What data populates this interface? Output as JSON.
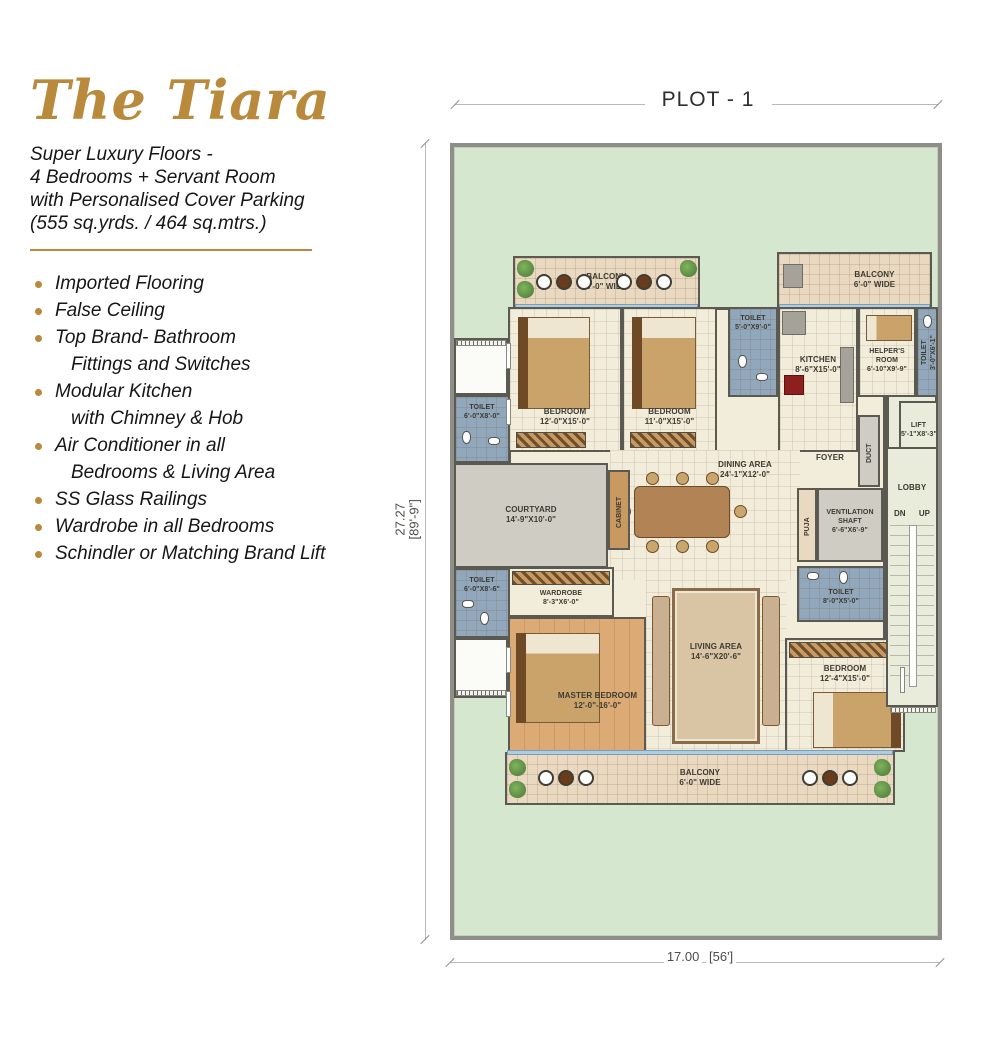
{
  "colors": {
    "accent": "#b9893c",
    "plot_green": "#d5e7ce",
    "toilet_blue": "#91a7bc"
  },
  "brand": {
    "title": "The Tiara",
    "subtitle_lines": [
      "Super Luxury Floors -",
      "4 Bedrooms + Servant Room",
      "with Personalised Cover Parking",
      "(555 sq.yrds. / 464 sq.mtrs.)"
    ]
  },
  "features": [
    {
      "text": "Imported Flooring"
    },
    {
      "text": "False Ceiling"
    },
    {
      "text": "Top Brand- Bathroom",
      "text2": "Fittings and Switches"
    },
    {
      "text": "Modular Kitchen",
      "text2": "with Chimney & Hob"
    },
    {
      "text": "Air Conditioner in all",
      "text2": "Bedrooms & Living Area"
    },
    {
      "text": "SS Glass Railings"
    },
    {
      "text": "Wardrobe in all Bedrooms"
    },
    {
      "text": "Schindler or Matching Brand Lift"
    }
  ],
  "plan": {
    "plot_label": "PLOT - 1",
    "dimensions": {
      "height_m": "27.27",
      "height_ft": "[89'-9\"]",
      "width_m": "17.00",
      "width_ft": "[56']"
    },
    "rooms": {
      "balcony_tl": {
        "name": "BALCONY",
        "dims": "6'-0\" WIDE"
      },
      "balcony_tr": {
        "name": "BALCONY",
        "dims": "6'-0\" WIDE"
      },
      "balcony_bottom": {
        "name": "BALCONY",
        "dims": "6'-0\" WIDE"
      },
      "bedroom1": {
        "name": "BEDROOM",
        "dims": "12'-0\"X15'-0\""
      },
      "bedroom2": {
        "name": "BEDROOM",
        "dims": "11'-0\"X15'-0\""
      },
      "toilet_top": {
        "name": "TOILET",
        "dims": "5'-0\"X9'-0\""
      },
      "kitchen": {
        "name": "KITCHEN",
        "dims": "8'-6\"X15'-0\""
      },
      "helpers_room": {
        "name": "HELPER'S ROOM",
        "dims": "6'-10\"X9'-9\""
      },
      "toilet_helpers": {
        "name": "TOILET",
        "dims": "3'-0\"X6'-1\""
      },
      "lift": {
        "name": "LIFT",
        "dims": "5'-1\"X8'-3\""
      },
      "duct": {
        "name": "DUCT"
      },
      "foyer": {
        "name": "FOYER"
      },
      "courtyard": {
        "name": "COURTYARD",
        "dims": "14'-9\"X10'-0\""
      },
      "cabinet": {
        "name": "CABINET"
      },
      "dining": {
        "name": "DINING AREA",
        "dims": "24'-1\"X12'-0\""
      },
      "toilet_left_upper": {
        "name": "TOILET",
        "dims": "6'-0\"X8'-0\""
      },
      "toilet_left_lower": {
        "name": "TOILET",
        "dims": "6'-0\"X8'-6\""
      },
      "wardrobe": {
        "name": "WARDROBE",
        "dims": "8'-3\"X6'-0\""
      },
      "master_bedroom": {
        "name": "MASTER BEDROOM",
        "dims": "12'-0\"-16'-0\""
      },
      "living": {
        "name": "LIVING AREA",
        "dims": "14'-6\"X20'-6\""
      },
      "puja": {
        "name": "PUJA"
      },
      "vent_shaft": {
        "name": "VENTILATION SHAFT",
        "dims": "6'-6\"X6'-9\""
      },
      "toilet_right": {
        "name": "TOILET",
        "dims": "8'-0\"X5'-0\""
      },
      "bedroom3": {
        "name": "BEDROOM",
        "dims": "12'-4\"X15'-0\""
      },
      "lobby": {
        "name": "LOBBY"
      },
      "stairs": {
        "dn": "DN",
        "up": "UP"
      }
    }
  }
}
